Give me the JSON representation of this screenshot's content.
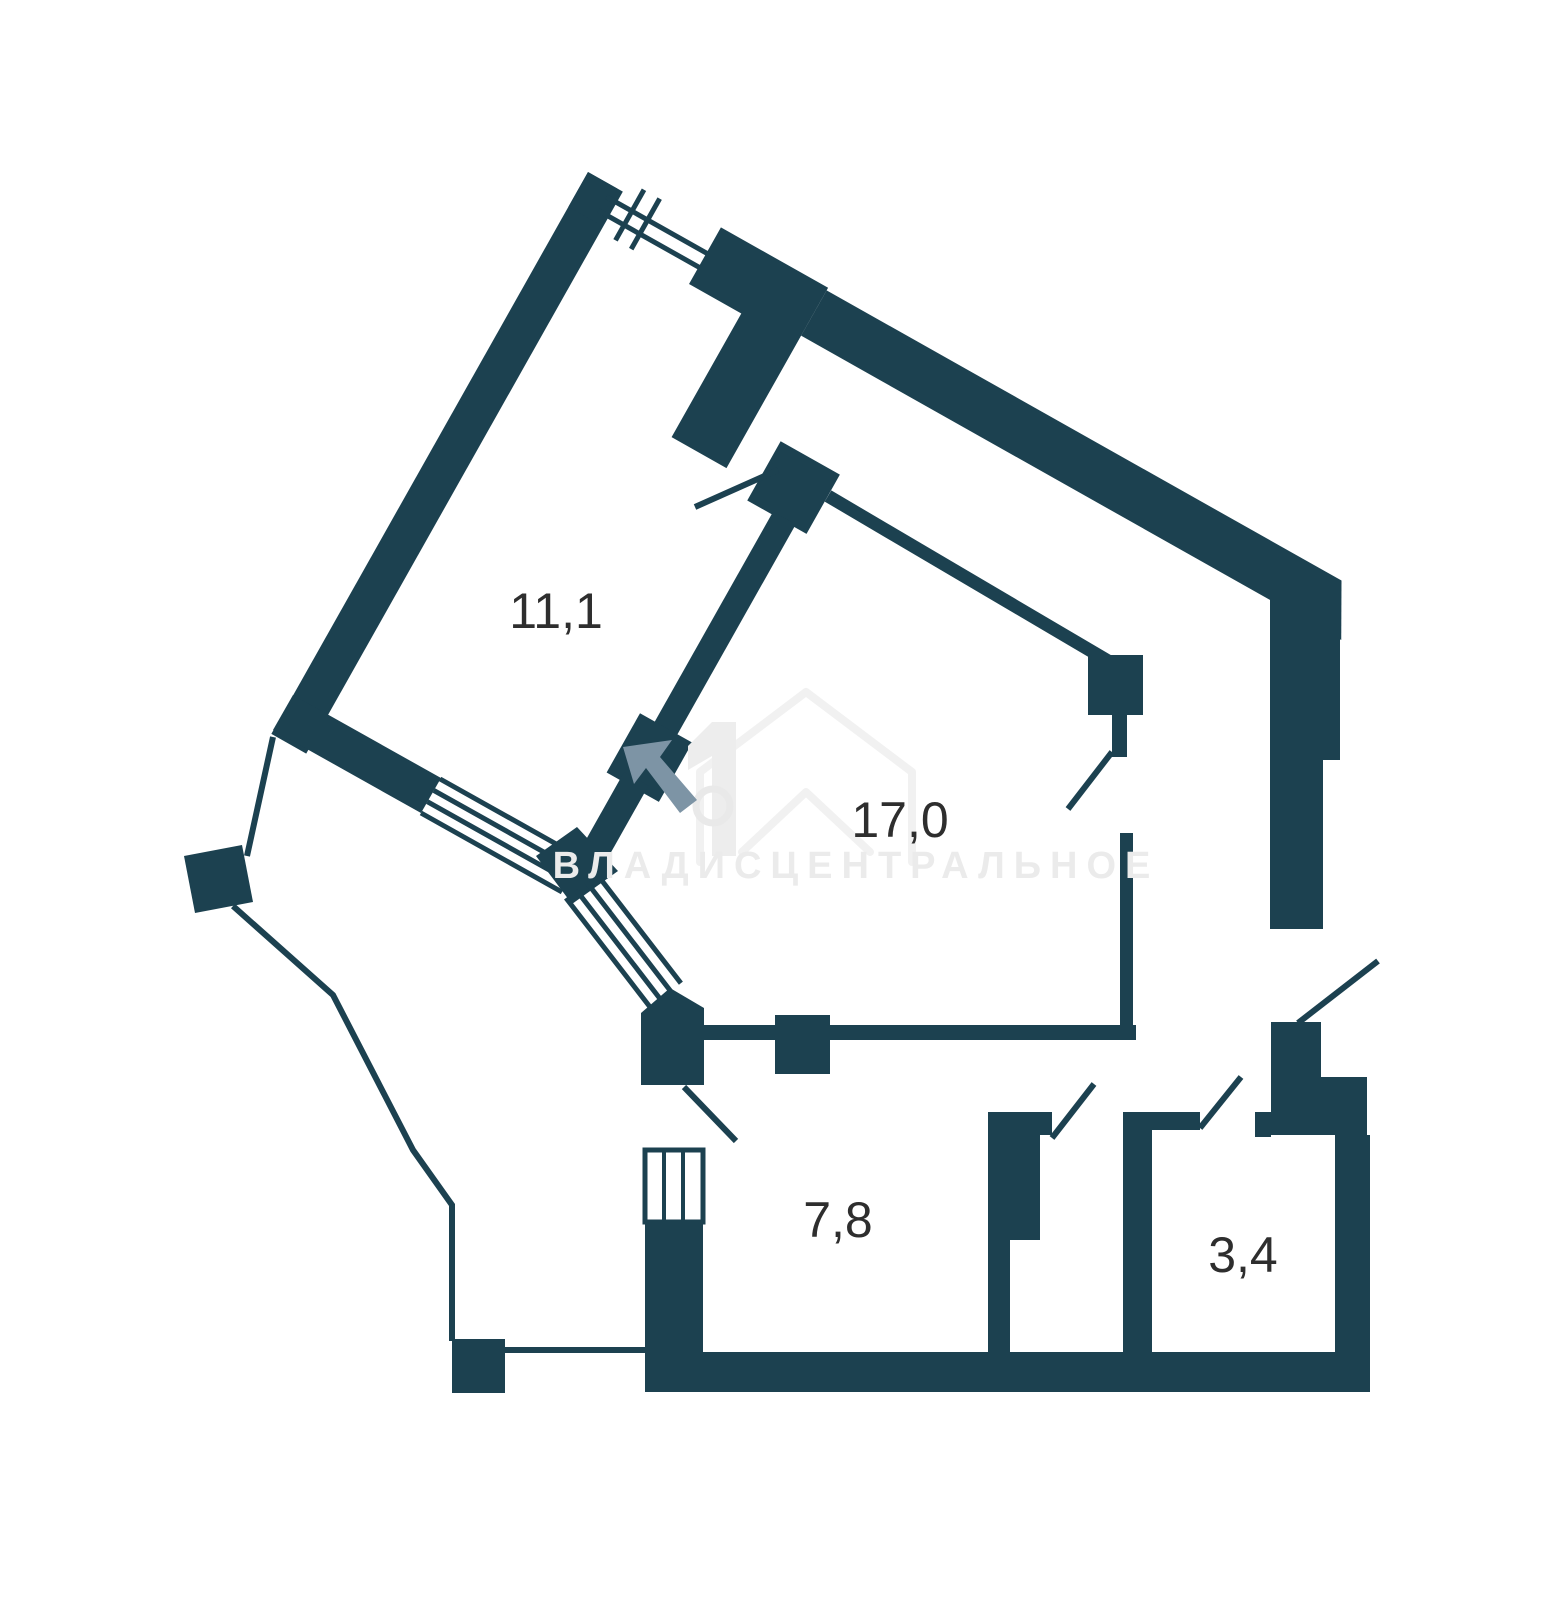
{
  "plan": {
    "type": "apartment-floor-plan",
    "rooms": [
      {
        "id": "room-1",
        "area_label": "11,1"
      },
      {
        "id": "room-2",
        "area_label": "17,0"
      },
      {
        "id": "room-3",
        "area_label": "7,8"
      },
      {
        "id": "room-4",
        "area_label": "3,4"
      }
    ],
    "watermark": {
      "text": "ВЛАДИСЦЕНТРАЛЬНОЕ",
      "logo_numeral": "1",
      "logo": "house-outline-icon",
      "arrow": "cursor-arrow-icon"
    },
    "colors": {
      "walls": "#1c4150",
      "background": "#ffffff",
      "label_text": "#2e2e2e",
      "watermark_text": "#ebebeb",
      "watermark_arrow": "#7d94a5"
    }
  }
}
